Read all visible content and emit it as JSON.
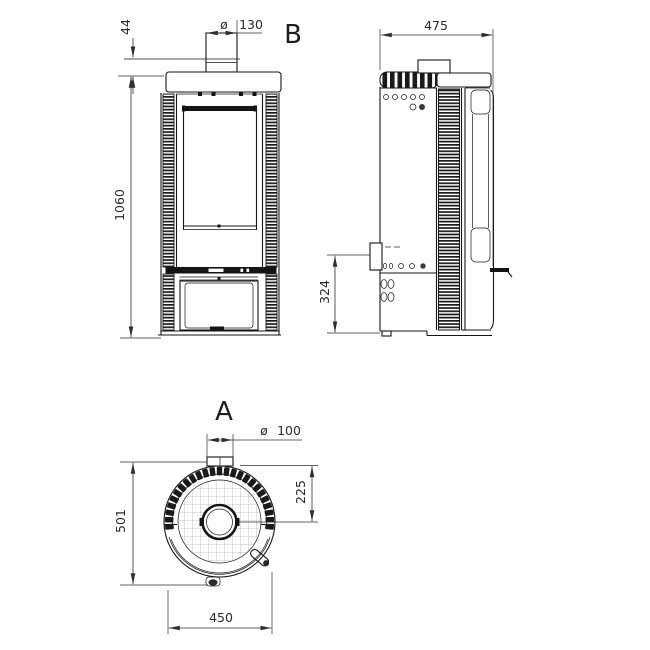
{
  "drawing": {
    "view_b_label": "B",
    "view_a_label": "A",
    "diameter_symbol": "ø",
    "front": {
      "collar_height": "44",
      "flue_diameter": "130",
      "total_height": "1060"
    },
    "side": {
      "depth": "475",
      "air_inlet_height": "324"
    },
    "top": {
      "air_diameter": "100",
      "flue_center_offset": "225",
      "total_depth": "501",
      "width": "450"
    }
  }
}
